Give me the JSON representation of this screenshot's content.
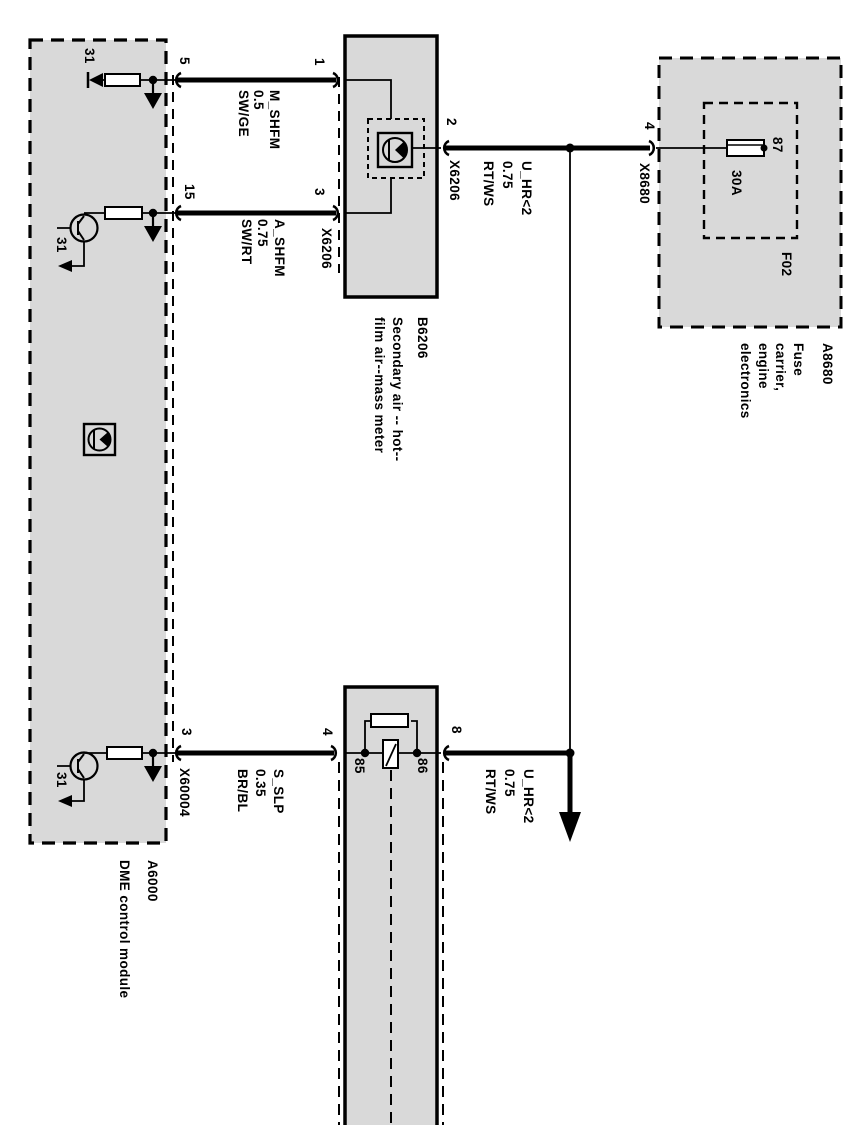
{
  "diagram_type": "automotive wiring schematic (rotated 90 degrees)",
  "colors": {
    "module_fill": "#d9d9d9",
    "line_color": "#000000",
    "page_background": "#ffffff"
  },
  "modules": {
    "dme": {
      "code": "A6000",
      "name": "DME control module",
      "pin_5": "5",
      "pin_15": "15",
      "pin_3": "3",
      "ground_1": "31",
      "ground_2": "31",
      "ground_3": "31",
      "connector": "X60004"
    },
    "hfm": {
      "code": "B6206",
      "name": "Secondary air -- hot--\nfilm air--mass meter",
      "pin_1": "1",
      "pin_3": "3",
      "pin_2": "2",
      "connector_a": "X6206",
      "connector_b": "X6206"
    },
    "fuse_carrier": {
      "code": "A8680",
      "name": "Fuse carrier, engine\nelectronics",
      "slot": "F02",
      "rating": "30A",
      "pin_87": "87",
      "pin_4": "4",
      "connector": "X8680"
    },
    "relay": {
      "pin_4": "4",
      "pin_8": "8",
      "pin_85": "85",
      "pin_86": "86"
    }
  },
  "wires": {
    "m_shfm": "M_SHFM\n0.5\nSW/GE",
    "a_shfm": "A_SHFM\n0.75\nSW/RT",
    "u_hr_top": "U_HR<2\n0.75\nRT/WS",
    "s_slp": "S_SLP\n0.35\nBR/BL",
    "u_hr_bottom": "U_HR<2\n0.75\nRT/WS"
  }
}
